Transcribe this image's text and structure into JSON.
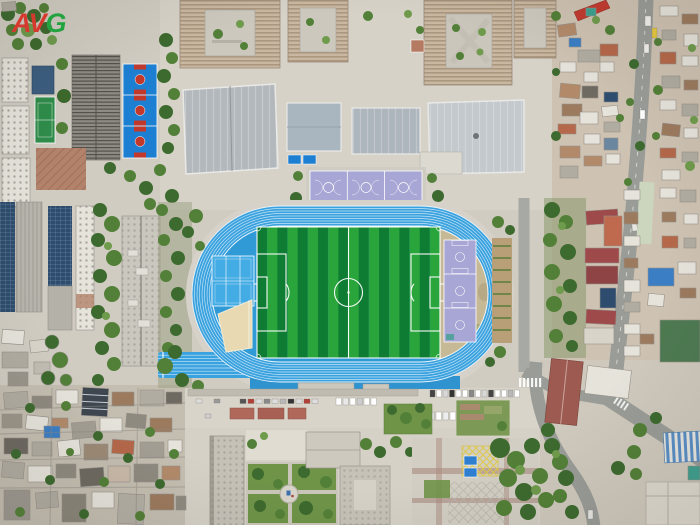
{
  "image": {
    "type": "aerial-drone-photo",
    "subject": "Top-down aerial view of a school sports complex: bright blue 8-lane running track around a green striped football pitch, blue and lavender courts, campus buildings with courtyards, dense residential blocks and roads around it",
    "width_px": 700,
    "height_px": 525
  },
  "watermark": {
    "av": "AV",
    "g": "G"
  },
  "palette": {
    "bg": "#d0ccc2",
    "concrete": "#d6d2c8",
    "concrete-dark": "#c3beb2",
    "plaza-white": "#e0dcd2",
    "track-blue": "#3aa2df",
    "track-blue-deep": "#2f93cf",
    "infield-blue": "#2f9ad6",
    "court-blue": "#44ace4",
    "field-green-dark": "#0f7c33",
    "field-green-light": "#2aa53c",
    "lavender": "#a8a6d5",
    "sand": "#e8d9b2",
    "dirt": "#c6b996",
    "bball-blue": "#1d7fd2",
    "bball-red": "#c2392c",
    "tennis-green": "#2f8d4a",
    "tree-dark": "#3d6a2f",
    "tree-mid": "#538038",
    "tree-light": "#6f9b4c",
    "lawn": "#6f9448",
    "grass-dull": "#9aa07f",
    "roof-white": "#e6e3db",
    "roof-gray": "#b0aca1",
    "roof-dark": "#6e6a62",
    "roof-brown": "#9c7a5e",
    "roof-tan": "#b28a6a",
    "roof-terra": "#b5684a",
    "roof-red": "#c23b30",
    "roof-maroon": "#9e4a4a",
    "roof-orange": "#bf6a4e",
    "tarp-blue": "#3b7ec4",
    "teal": "#3fa08f",
    "road": "#9a9c97",
    "solar": "#2e4d6e",
    "gym-roof": "#b3b8bc",
    "gym-roof-light": "#c3c9cd",
    "beige": "#c6b49e",
    "navy-roof": "#3e4650",
    "yellow": "#e0c840",
    "white-line": "#ffffff",
    "logo-red": "#d63a2e",
    "logo-green": "#23a33f"
  },
  "regions": [
    {
      "id": "stadium",
      "label": "School stadium"
    },
    {
      "id": "running-track",
      "label": "Blue 8-lane running track with sprint extension"
    },
    {
      "id": "football-field",
      "label": "Green striped football pitch with white markings"
    },
    {
      "id": "multi-courts-west",
      "label": "Blue multi-use courts inside west curve"
    },
    {
      "id": "sand-pit",
      "label": "Long jump sand pit"
    },
    {
      "id": "basketball-courts-east",
      "label": "Lavender basketball courts inside east curve"
    },
    {
      "id": "basketball-courts-north",
      "label": "Lavender basketball courts north of the track"
    },
    {
      "id": "blue-basketball-courts",
      "label": "Blue basketball courts with red keys"
    },
    {
      "id": "tennis-court",
      "label": "Green court"
    },
    {
      "id": "gymnasiums",
      "label": "Large gray gymnasium roofs"
    },
    {
      "id": "courtyard-buildings",
      "label": "Campus blocks with inner courtyards"
    },
    {
      "id": "solar-buildings",
      "label": "Buildings with rooftop solar panels"
    },
    {
      "id": "residential-east",
      "label": "Dense low-rise residential rooftops"
    },
    {
      "id": "old-town-southwest",
      "label": "Dense old-town rooftops"
    },
    {
      "id": "parking-plaza",
      "label": "Plaza with rows of parked cars and bike shelters"
    },
    {
      "id": "garden-south",
      "label": "Formal quadrant garden with circular center"
    },
    {
      "id": "roads",
      "label": "City roads with crosswalks and vehicles"
    }
  ]
}
